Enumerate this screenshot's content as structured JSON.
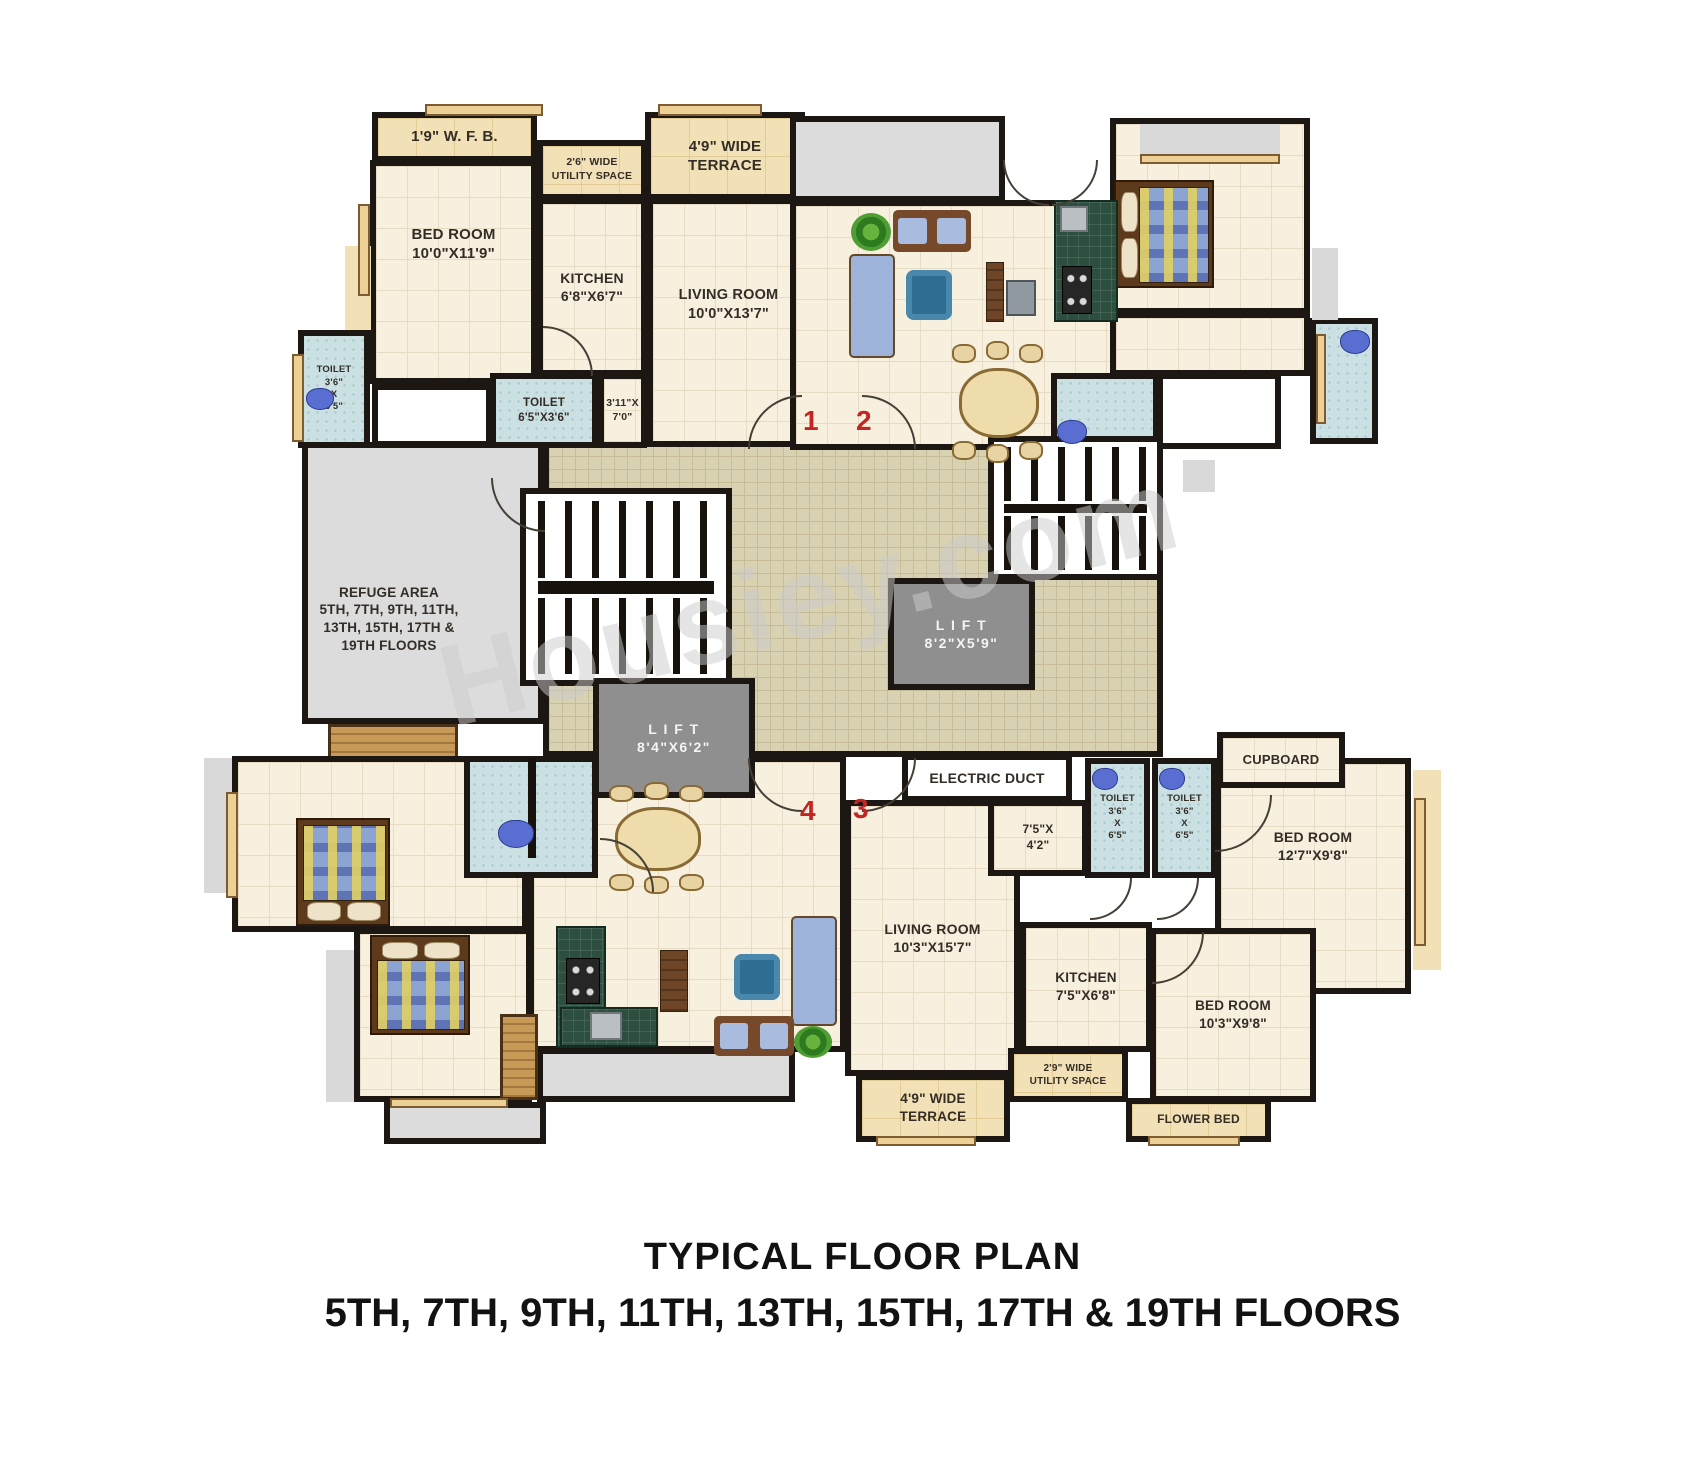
{
  "meta": {
    "title_line1": "TYPICAL FLOOR PLAN",
    "title_line2": "5TH, 7TH, 9TH, 11TH, 13TH, 15TH, 17TH & 19TH FLOORS",
    "watermark": "Housiey.com"
  },
  "colors": {
    "wall": "#1c1712",
    "floor_cream": "#f8f0df",
    "toilet_blue": "#cbe0e3",
    "terrace_tan": "#f2e0b6",
    "lobby_tile": "#d8d1b2",
    "refuge_grey": "#dcdcdc",
    "lift_grey": "#8f8f8f",
    "counter_green": "#2c4f40",
    "unit_number_red": "#c32522",
    "watermark_grey": "#cdcdcd"
  },
  "rooms": [
    {
      "id": "lobby",
      "type": "lobby",
      "x": 543,
      "y": 424,
      "w": 620,
      "h": 333,
      "label": []
    },
    {
      "id": "wfb-1",
      "type": "terrace",
      "x": 372,
      "y": 112,
      "w": 165,
      "h": 50,
      "label": [
        "1'9\" W. F. B."
      ],
      "fs": 15
    },
    {
      "id": "terrace-top-1",
      "type": "terrace",
      "x": 645,
      "y": 112,
      "w": 160,
      "h": 88,
      "label": [
        "4'9\" WIDE",
        "TERRACE"
      ],
      "fs": 15
    },
    {
      "id": "utility-top-1",
      "type": "terrace",
      "x": 537,
      "y": 140,
      "w": 110,
      "h": 60,
      "label": [
        "2'6\" WIDE",
        "UTILITY SPACE"
      ],
      "fs": 10.5
    },
    {
      "id": "bedroom-1",
      "type": "cream",
      "x": 370,
      "y": 160,
      "w": 167,
      "h": 224,
      "label": [
        "BED ROOM",
        "10'0\"X11'9\""
      ],
      "fs": 15,
      "dy": -28
    },
    {
      "id": "kitchen-1",
      "type": "cream",
      "x": 537,
      "y": 198,
      "w": 110,
      "h": 178,
      "label": [
        "KITCHEN",
        "6'8\"X6'7\""
      ],
      "fs": 14
    },
    {
      "id": "living-1",
      "type": "cream",
      "x": 647,
      "y": 198,
      "w": 163,
      "h": 249,
      "label": [
        "LIVING ROOM",
        "10'0\"X13'7\""
      ],
      "fs": 14.5,
      "dy": -18
    },
    {
      "id": "hall-1",
      "type": "white",
      "x": 372,
      "y": 384,
      "w": 120,
      "h": 63,
      "label": []
    },
    {
      "id": "toilet-1a",
      "type": "toilet",
      "x": 298,
      "y": 330,
      "w": 72,
      "h": 118,
      "label": [
        "TOILET",
        "3'6\"",
        "X",
        "6'5\""
      ],
      "fs": 9.5
    },
    {
      "id": "toilet-1b",
      "type": "toilet",
      "x": 490,
      "y": 373,
      "w": 108,
      "h": 75,
      "label": [
        "TOILET",
        "6'5\"X3'6\""
      ],
      "fs": 11.5
    },
    {
      "id": "passage-1",
      "type": "cream",
      "x": 598,
      "y": 373,
      "w": 49,
      "h": 75,
      "label": [
        "3'11\"X",
        "7'0\""
      ],
      "fs": 10.5
    },
    {
      "id": "ledge-1",
      "type": "terrace-plain",
      "x": 345,
      "y": 246,
      "w": 26,
      "h": 84,
      "label": []
    },
    {
      "id": "terrace-2",
      "type": "grey",
      "x": 790,
      "y": 116,
      "w": 215,
      "h": 86,
      "label": []
    },
    {
      "id": "living-2",
      "type": "cream",
      "x": 790,
      "y": 200,
      "w": 335,
      "h": 250,
      "label": []
    },
    {
      "id": "bedroom-2",
      "type": "cream",
      "x": 1110,
      "y": 118,
      "w": 200,
      "h": 196,
      "label": []
    },
    {
      "id": "hall-2",
      "type": "cream",
      "x": 1110,
      "y": 312,
      "w": 200,
      "h": 64,
      "label": []
    },
    {
      "id": "toilet-2a",
      "type": "toilet",
      "x": 1051,
      "y": 373,
      "w": 108,
      "h": 76,
      "label": []
    },
    {
      "id": "store-2",
      "type": "white",
      "x": 1157,
      "y": 373,
      "w": 124,
      "h": 76,
      "label": []
    },
    {
      "id": "toilet-2b",
      "type": "toilet",
      "x": 1310,
      "y": 318,
      "w": 68,
      "h": 126,
      "label": []
    },
    {
      "id": "ledge-2a",
      "type": "greyplain",
      "x": 1140,
      "y": 124,
      "w": 140,
      "h": 32,
      "label": []
    },
    {
      "id": "ledge-2b",
      "type": "greyplain",
      "x": 1312,
      "y": 248,
      "w": 26,
      "h": 72,
      "label": []
    },
    {
      "id": "ledge-2c",
      "type": "greyplain",
      "x": 1183,
      "y": 460,
      "w": 32,
      "h": 32,
      "label": []
    },
    {
      "id": "refuge-area",
      "type": "grey",
      "x": 302,
      "y": 442,
      "w": 242,
      "h": 282,
      "label": [
        "REFUGE AREA",
        "5TH, 7TH, 9TH, 11TH,",
        "13TH, 15TH, 17TH &",
        "19TH FLOORS"
      ],
      "fs": 13.5,
      "dx": -34,
      "dy": 36
    },
    {
      "id": "wood-deck",
      "type": "wood",
      "x": 328,
      "y": 724,
      "w": 130,
      "h": 50,
      "label": []
    },
    {
      "id": "living-3",
      "type": "cream",
      "x": 845,
      "y": 800,
      "w": 175,
      "h": 276,
      "label": [
        "LIVING ROOM",
        "10'3\"X15'7\""
      ],
      "fs": 14
    },
    {
      "id": "entry-3",
      "type": "cream",
      "x": 988,
      "y": 800,
      "w": 100,
      "h": 76,
      "label": [
        "7'5\"X",
        "4'2\""
      ],
      "fs": 12
    },
    {
      "id": "toilet-3a",
      "type": "toilet",
      "x": 1085,
      "y": 758,
      "w": 65,
      "h": 120,
      "label": [
        "TOILET",
        "3'6\"",
        "X",
        "6'5\""
      ],
      "fs": 9.5
    },
    {
      "id": "toilet-3b",
      "type": "toilet",
      "x": 1152,
      "y": 758,
      "w": 65,
      "h": 120,
      "label": [
        "TOILET",
        "3'6\"",
        "X",
        "6'5\""
      ],
      "fs": 9.5
    },
    {
      "id": "bedroom-3a",
      "type": "cream",
      "x": 1215,
      "y": 758,
      "w": 196,
      "h": 236,
      "label": [
        "BED ROOM",
        "12'7\"X9'8\""
      ],
      "fs": 14,
      "dy": -30
    },
    {
      "id": "cupboard-3",
      "type": "cream",
      "x": 1217,
      "y": 732,
      "w": 128,
      "h": 56,
      "label": [
        "CUPBOARD"
      ],
      "fs": 13
    },
    {
      "id": "balcony-3",
      "type": "terrace-plain",
      "x": 1413,
      "y": 770,
      "w": 28,
      "h": 200,
      "label": []
    },
    {
      "id": "kitchen-3",
      "type": "cream",
      "x": 1020,
      "y": 922,
      "w": 132,
      "h": 130,
      "label": [
        "KITCHEN",
        "7'5\"X6'8\""
      ],
      "fs": 13.5
    },
    {
      "id": "utility-3",
      "type": "terrace",
      "x": 1008,
      "y": 1048,
      "w": 120,
      "h": 54,
      "label": [
        "2'9\" WIDE",
        "UTILITY SPACE"
      ],
      "fs": 10
    },
    {
      "id": "bedroom-3b",
      "type": "cream",
      "x": 1150,
      "y": 928,
      "w": 166,
      "h": 174,
      "label": [
        "BED ROOM",
        "10'3\"X9'8\""
      ],
      "fs": 13.5
    },
    {
      "id": "flower-bed-3",
      "type": "terrace",
      "x": 1126,
      "y": 1098,
      "w": 145,
      "h": 44,
      "label": [
        "FLOWER BED"
      ],
      "fs": 12
    },
    {
      "id": "terrace-3",
      "type": "terrace",
      "x": 856,
      "y": 1074,
      "w": 154,
      "h": 68,
      "label": [
        "4'9\" WIDE",
        "TERRACE"
      ],
      "fs": 13.5
    },
    {
      "id": "bedroom-4a",
      "type": "cream",
      "x": 232,
      "y": 756,
      "w": 296,
      "h": 176,
      "label": []
    },
    {
      "id": "bedroom-4b",
      "type": "cream",
      "x": 354,
      "y": 928,
      "w": 178,
      "h": 174,
      "label": []
    },
    {
      "id": "living-4",
      "type": "cream",
      "x": 528,
      "y": 756,
      "w": 318,
      "h": 296,
      "label": []
    },
    {
      "id": "toilet-4",
      "type": "toilet",
      "x": 464,
      "y": 756,
      "w": 134,
      "h": 122,
      "label": []
    },
    {
      "id": "ledge-4a",
      "type": "greyplain",
      "x": 204,
      "y": 758,
      "w": 28,
      "h": 135,
      "label": []
    },
    {
      "id": "ledge-4b",
      "type": "greyplain",
      "x": 326,
      "y": 950,
      "w": 28,
      "h": 152,
      "label": []
    },
    {
      "id": "passage-4",
      "type": "grey",
      "x": 537,
      "y": 1048,
      "w": 258,
      "h": 54,
      "label": []
    },
    {
      "id": "cabinet-4",
      "type": "wood",
      "x": 500,
      "y": 1014,
      "w": 38,
      "h": 86,
      "label": []
    },
    {
      "id": "terrace-4",
      "type": "grey",
      "x": 384,
      "y": 1102,
      "w": 162,
      "h": 42,
      "label": []
    },
    {
      "id": "staircase-main",
      "type": "stairs",
      "x": 520,
      "y": 488,
      "w": 212,
      "h": 198,
      "label": []
    },
    {
      "id": "staircase-right",
      "type": "stairs",
      "x": 988,
      "y": 436,
      "w": 175,
      "h": 144,
      "label": []
    },
    {
      "id": "lift-a",
      "type": "lift",
      "x": 888,
      "y": 578,
      "w": 147,
      "h": 112,
      "label": [
        "L I F T",
        "8'2\"X5'9\""
      ],
      "fs": 14
    },
    {
      "id": "lift-b",
      "type": "lift",
      "x": 593,
      "y": 678,
      "w": 162,
      "h": 120,
      "label": [
        "L I F T",
        "8'4\"X6'2\""
      ],
      "fs": 14
    },
    {
      "id": "electric-duct",
      "type": "white",
      "x": 902,
      "y": 754,
      "w": 170,
      "h": 48,
      "label": [
        "ELECTRIC DUCT"
      ],
      "fs": 14
    }
  ],
  "furniture": [
    {
      "kind": "bed",
      "x": 1114,
      "y": 180,
      "w": 100,
      "h": 108,
      "variant": "pillows-left"
    },
    {
      "kind": "corner-sofa",
      "x": 893,
      "y": 210,
      "w": 78,
      "h": 42
    },
    {
      "kind": "sofa",
      "x": 849,
      "y": 254,
      "w": 46,
      "h": 104
    },
    {
      "kind": "rug",
      "x": 906,
      "y": 270,
      "w": 46,
      "h": 50
    },
    {
      "kind": "cabinet",
      "x": 986,
      "y": 262,
      "w": 18,
      "h": 60
    },
    {
      "kind": "tv",
      "x": 1006,
      "y": 280,
      "w": 30,
      "h": 36
    },
    {
      "kind": "dining",
      "x": 944,
      "y": 356,
      "w": 104,
      "h": 88
    },
    {
      "kind": "counter",
      "x": 1054,
      "y": 200,
      "w": 64,
      "h": 122
    },
    {
      "kind": "sink",
      "x": 1060,
      "y": 206,
      "w": 28,
      "h": 26
    },
    {
      "kind": "stove",
      "x": 1062,
      "y": 266,
      "w": 30,
      "h": 48
    },
    {
      "kind": "plant",
      "x": 851,
      "y": 213,
      "w": 40,
      "h": 38
    },
    {
      "kind": "wc",
      "x": 1340,
      "y": 330,
      "w": 30,
      "h": 24
    },
    {
      "kind": "wc",
      "x": 1057,
      "y": 420,
      "w": 30,
      "h": 24
    },
    {
      "kind": "wc",
      "x": 306,
      "y": 388,
      "w": 28,
      "h": 22
    },
    {
      "kind": "bed",
      "x": 296,
      "y": 818,
      "w": 94,
      "h": 108,
      "variant": "pillows-bottom"
    },
    {
      "kind": "bed",
      "x": 370,
      "y": 935,
      "w": 100,
      "h": 100,
      "variant": "pillows-top"
    },
    {
      "kind": "divider",
      "x": 528,
      "y": 758,
      "w": 8,
      "h": 100
    },
    {
      "kind": "wc",
      "x": 498,
      "y": 820,
      "w": 36,
      "h": 28
    },
    {
      "kind": "dining",
      "x": 600,
      "y": 796,
      "w": 110,
      "h": 80
    },
    {
      "kind": "counter",
      "x": 556,
      "y": 926,
      "w": 50,
      "h": 122
    },
    {
      "kind": "counter",
      "x": 560,
      "y": 1007,
      "w": 98,
      "h": 40
    },
    {
      "kind": "stove",
      "x": 566,
      "y": 958,
      "w": 34,
      "h": 46
    },
    {
      "kind": "sink",
      "x": 590,
      "y": 1012,
      "w": 32,
      "h": 28
    },
    {
      "kind": "cabinet",
      "x": 660,
      "y": 950,
      "w": 28,
      "h": 62
    },
    {
      "kind": "sofa",
      "x": 791,
      "y": 916,
      "w": 46,
      "h": 110
    },
    {
      "kind": "corner-sofa",
      "x": 714,
      "y": 1016,
      "w": 80,
      "h": 40
    },
    {
      "kind": "rug",
      "x": 734,
      "y": 954,
      "w": 46,
      "h": 46
    },
    {
      "kind": "plant",
      "x": 794,
      "y": 1026,
      "w": 38,
      "h": 32
    },
    {
      "kind": "wc",
      "x": 1092,
      "y": 768,
      "w": 26,
      "h": 22
    },
    {
      "kind": "wc",
      "x": 1159,
      "y": 768,
      "w": 26,
      "h": 22
    }
  ],
  "windows": [
    {
      "x": 425,
      "y": 104,
      "w": 118,
      "h": 12
    },
    {
      "x": 658,
      "y": 104,
      "w": 104,
      "h": 12
    },
    {
      "x": 1140,
      "y": 154,
      "w": 140,
      "h": 10
    },
    {
      "x": 358,
      "y": 204,
      "w": 12,
      "h": 92
    },
    {
      "x": 292,
      "y": 354,
      "w": 12,
      "h": 88
    },
    {
      "x": 1316,
      "y": 334,
      "w": 10,
      "h": 90
    },
    {
      "x": 1414,
      "y": 798,
      "w": 12,
      "h": 148
    },
    {
      "x": 876,
      "y": 1136,
      "w": 100,
      "h": 10
    },
    {
      "x": 1148,
      "y": 1136,
      "w": 92,
      "h": 10
    },
    {
      "x": 226,
      "y": 792,
      "w": 12,
      "h": 106
    },
    {
      "x": 390,
      "y": 1098,
      "w": 118,
      "h": 10
    }
  ],
  "arcs": [
    {
      "x": 748,
      "y": 395,
      "r": 52,
      "q": "tl"
    },
    {
      "x": 862,
      "y": 395,
      "r": 52,
      "q": "tr"
    },
    {
      "x": 748,
      "y": 758,
      "r": 52,
      "q": "bl"
    },
    {
      "x": 862,
      "y": 758,
      "r": 52,
      "q": "br"
    },
    {
      "x": 491,
      "y": 478,
      "r": 52,
      "q": "bl"
    },
    {
      "x": 543,
      "y": 326,
      "r": 48,
      "q": "tr"
    },
    {
      "x": 1003,
      "y": 160,
      "r": 44,
      "q": "bl"
    },
    {
      "x": 1052,
      "y": 160,
      "r": 44,
      "q": "br"
    },
    {
      "x": 1090,
      "y": 878,
      "r": 40,
      "q": "br"
    },
    {
      "x": 1157,
      "y": 878,
      "r": 40,
      "q": "br"
    },
    {
      "x": 1215,
      "y": 795,
      "r": 55,
      "q": "br"
    },
    {
      "x": 1152,
      "y": 932,
      "r": 50,
      "q": "br"
    },
    {
      "x": 600,
      "y": 838,
      "r": 52,
      "q": "tr"
    }
  ],
  "unit_numbers": [
    {
      "value": "1",
      "x": 803,
      "y": 405
    },
    {
      "value": "2",
      "x": 856,
      "y": 405
    },
    {
      "value": "4",
      "x": 800,
      "y": 795
    },
    {
      "value": "3",
      "x": 853,
      "y": 793
    }
  ]
}
